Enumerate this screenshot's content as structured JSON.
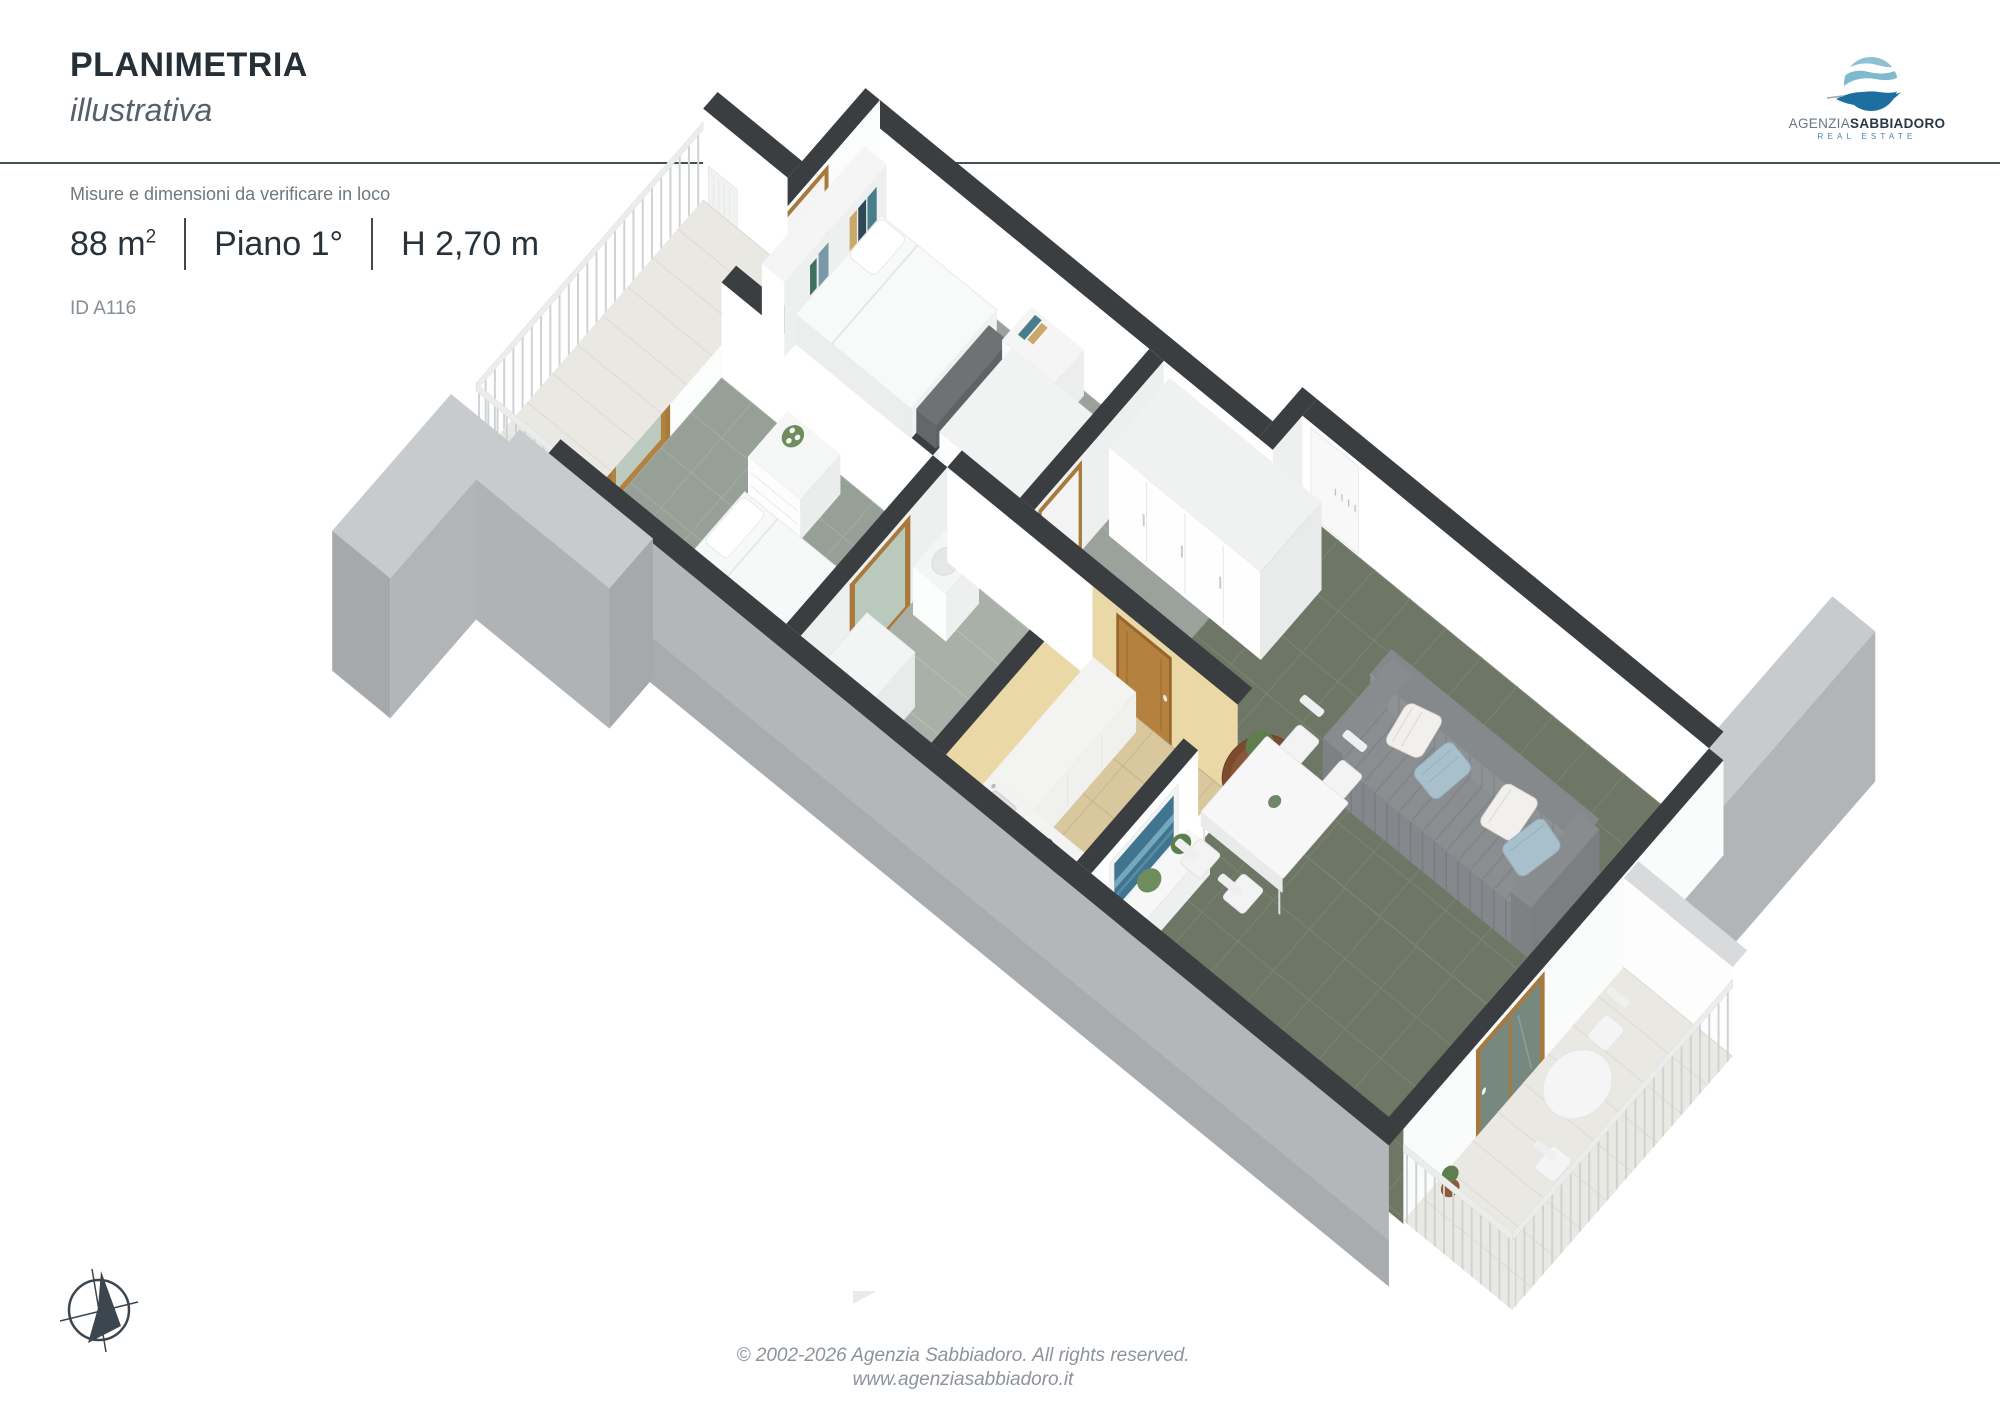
{
  "header": {
    "title": "PLANIMETRIA",
    "subtitle": "illustrativa"
  },
  "logo": {
    "brand_prefix": "AGENZIA",
    "brand_name": "SABBIADORO",
    "tagline": "REAL ESTATE",
    "globe_colors": {
      "light_blue": "#8ec2d3",
      "mid_blue": "#5ea3c0",
      "dark_blue": "#1d6f9f"
    }
  },
  "details": {
    "disclaimer": "Misure e dimensioni da verificare in loco",
    "area_value": "88 m",
    "area_sup": "2",
    "floor": "Piano 1°",
    "ceiling_height": "H 2,70 m",
    "listing_id": "ID A116"
  },
  "footer": {
    "copyright": "© 2002-2026 Agenzia Sabbiadoro. All rights reserved.",
    "website": "www.agenziasabbiadoro.it"
  },
  "floor_plan": {
    "type": "3d-isometric-floorplan",
    "colors": {
      "wall_top": "#3a3e40",
      "wall_inner": "#ffffff",
      "wall_outer": "#b4b7b9",
      "slab": "#c8cbcd",
      "living_floor": "#6e7765",
      "bedroom_floor": "#9aa29b",
      "kitchen_floor": "#d9c89e",
      "balcony_floor": "#eae8e2",
      "wood_door": "#b5813f",
      "sofa": "#8b8e91",
      "accent_wall": "#ead9a6"
    },
    "elements": [
      "balcony-with-railing",
      "bedroom-bed",
      "bookshelf-headboard",
      "wardrobe",
      "dresser-with-orchid",
      "single-bed",
      "bathroom-washing-machine",
      "hallway-wood-door",
      "entry-niche",
      "kitchen-counters",
      "tv-panel",
      "sofa-with-pillows",
      "coffee-table-plant",
      "dining-table-chairs",
      "living-balcony-table",
      "party-wall-slabs"
    ]
  }
}
